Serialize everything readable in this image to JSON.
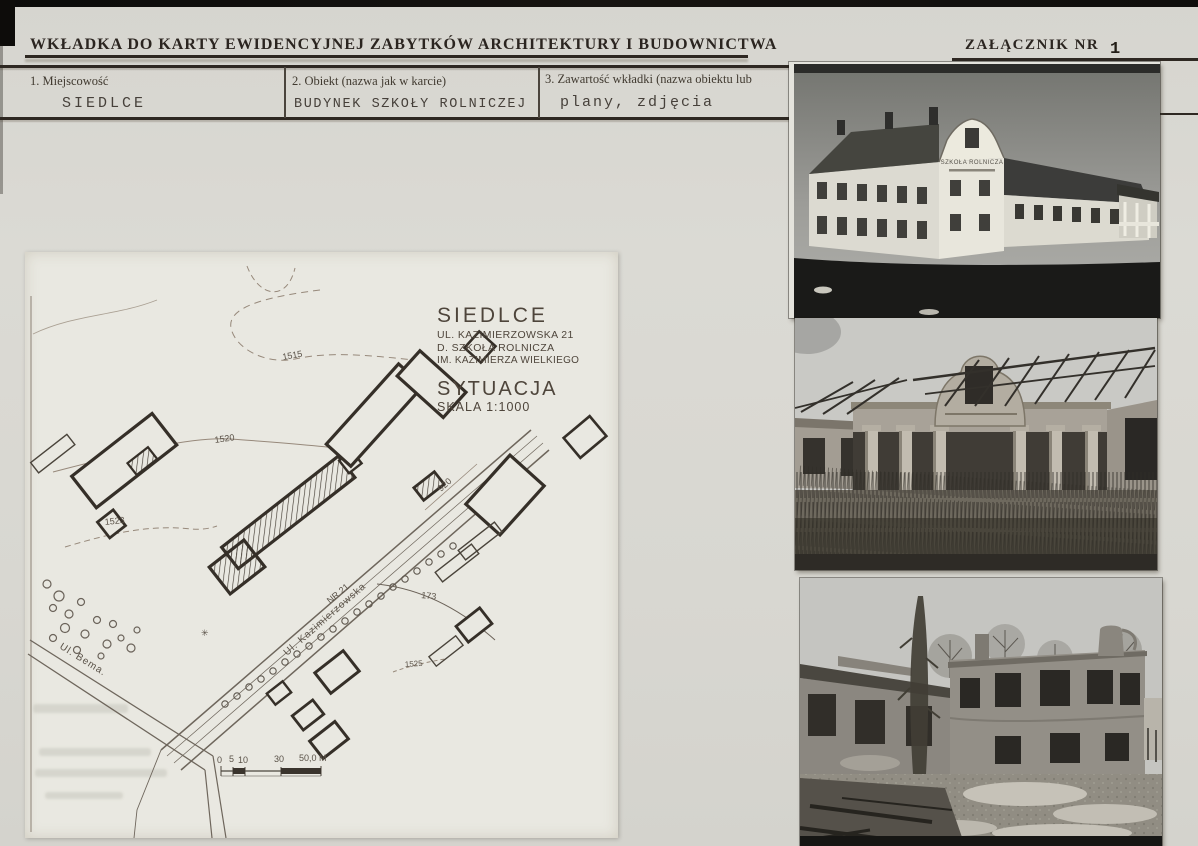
{
  "page": {
    "title": "WKŁADKA DO KARTY EWIDENCYJNEJ ZABYTKÓW ARCHITEKTURY I BUDOWNICTWA",
    "attachment_label": "ZAŁĄCZNIK NR",
    "attachment_number": "1"
  },
  "form": {
    "fields": [
      {
        "label": "1. Miejscowość",
        "value": "SIEDLCE"
      },
      {
        "label": "2. Obiekt (nazwa jak w karcie)",
        "value": "BUDYNEK SZKOŁY ROLNICZEJ"
      },
      {
        "label": "3. Zawartość wkładki (nazwa obiektu lub",
        "value": "plany, zdjęcia"
      }
    ]
  },
  "site_plan": {
    "title_block": {
      "city": "SIEDLCE",
      "address": "UL. KAZIMIERZOWSKA 21",
      "building_former_name": "D. SZKOŁA ROLNICZA",
      "building_patron": "IM. KAZIMIERZA WIELKIEGO",
      "drawing_type": "SYTUACJA",
      "scale": "SKALA 1:1000"
    },
    "labels": {
      "street_bema": "Ul. Bema.",
      "street_kazimierzowska": "Ul. Kazimierzowska",
      "plot_number": "NR 21",
      "road_920": "920",
      "contour_1515": "1515",
      "contour_1520": "1520",
      "contour_1523": "1523",
      "curve_173": "173",
      "contour_1525": "1525",
      "tree_symbol": "✳"
    },
    "scale_bar": {
      "tick_0": "0",
      "tick_5": "5",
      "tick_10": "10",
      "tick_30": "30",
      "end_label": "50,0 M"
    }
  },
  "photos": [
    {
      "name": "historic-school-building-photo",
      "sign_text": "SZKOŁA ROLNICZA"
    },
    {
      "name": "ruined-colonnade-photo"
    },
    {
      "name": "ruined-courtyard-photo"
    }
  ],
  "colors": {
    "paper": "#d9d8d2",
    "sheet": "#e9e8e1",
    "ink": "#2e2822",
    "plan_line": "#3a332c"
  }
}
